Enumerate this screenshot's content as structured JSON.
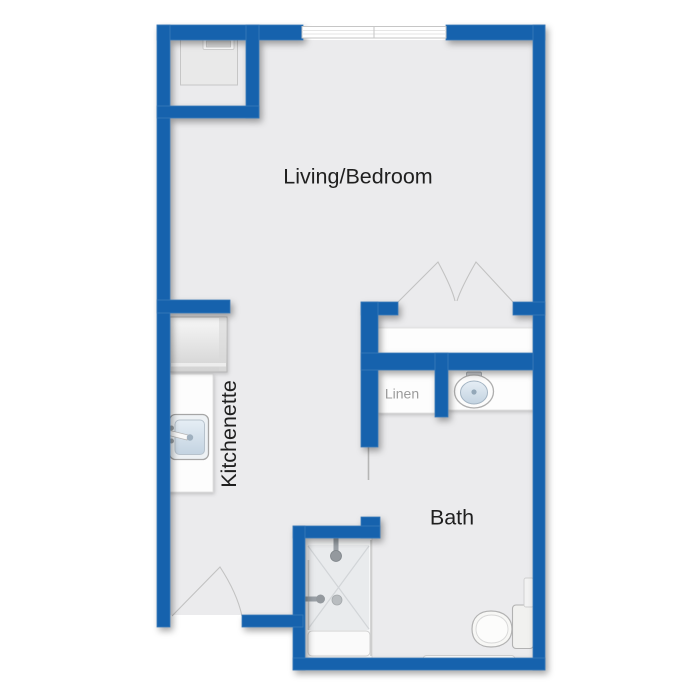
{
  "floorplan": {
    "labels": {
      "living_bedroom": "Living/Bedroom",
      "kitchenette": "Kitchenette",
      "bath": "Bath",
      "linen": "Linen"
    },
    "colors": {
      "wall": "#1262ad",
      "floor": "#ebebed",
      "background": "#ffffff",
      "counter": "#fdfdfd",
      "fixture_outline": "#b2b2b2",
      "basin": "#ccd9e6",
      "label_text": "#1f1f1f",
      "muted_text": "#9b9b9b"
    }
  }
}
